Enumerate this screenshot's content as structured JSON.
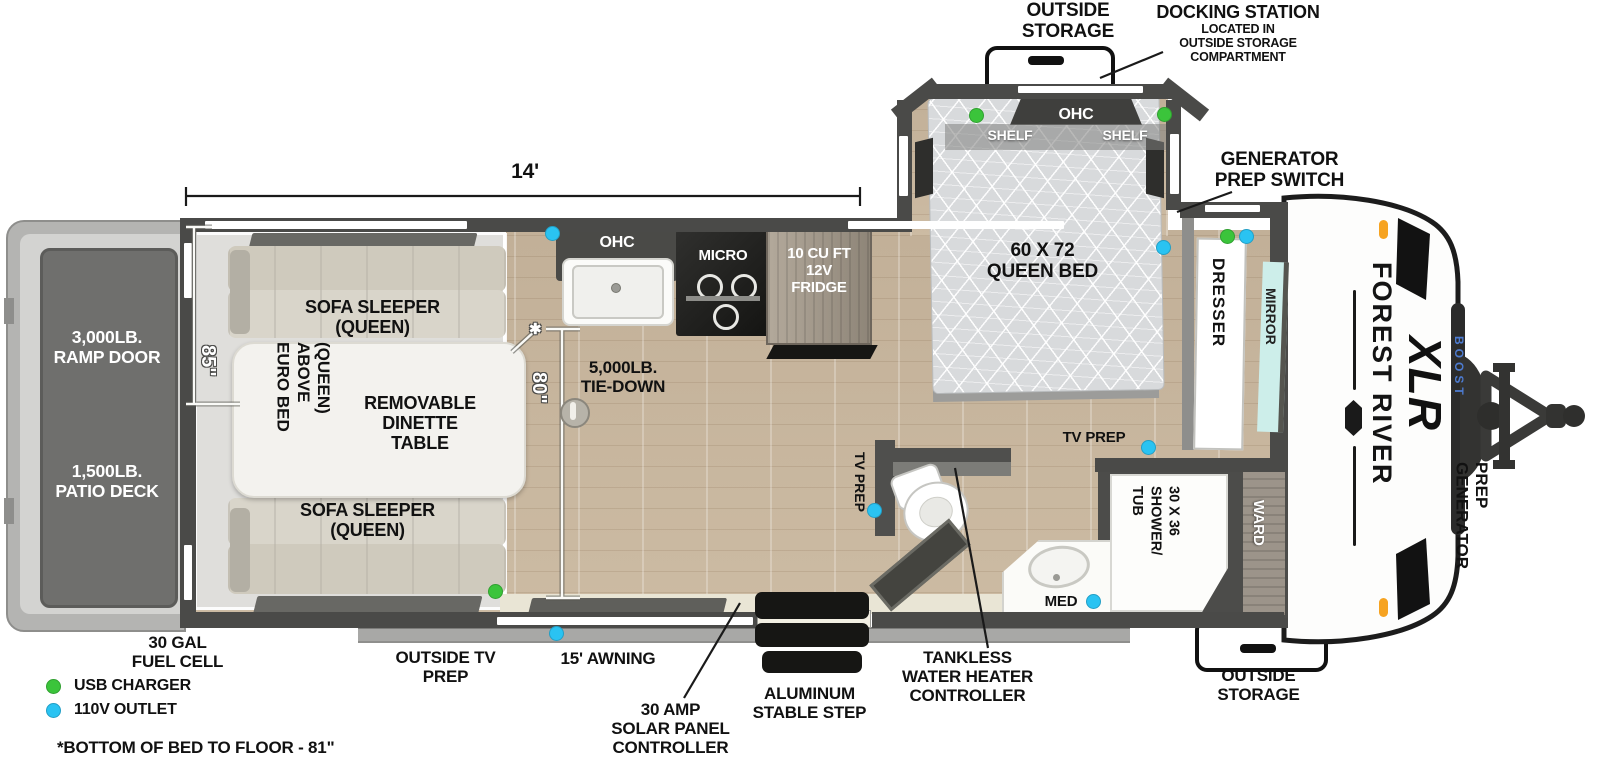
{
  "legend": {
    "usb_label": "USB CHARGER",
    "outlet_label": "110V OUTLET",
    "usb_color": "#3bc43b",
    "outlet_color": "#2ac3f2",
    "footnote": "*BOTTOM OF BED TO FLOOR - 81\""
  },
  "dimensions": {
    "length": "14'",
    "garage_depth": "85\"",
    "interior_height": "80\"",
    "floor_mark": "✱"
  },
  "exterior": {
    "outside_storage_top_l1": "OUTSIDE",
    "outside_storage_top_l2": "STORAGE",
    "docking_title": "DOCKING STATION",
    "docking_sub1": "LOCATED IN",
    "docking_sub2": "OUTSIDE STORAGE",
    "docking_sub3": "COMPARTMENT",
    "gen_switch_l1": "GENERATOR",
    "gen_switch_l2": "PREP SWITCH",
    "ramp_l1": "3,000LB.",
    "ramp_l2": "RAMP DOOR",
    "patio_l1": "1,500LB.",
    "patio_l2": "PATIO DECK",
    "fuel_l1": "30 GAL",
    "fuel_l2": "FUEL CELL",
    "outside_tv_l1": "OUTSIDE TV",
    "outside_tv_l2": "PREP",
    "awning": "15' AWNING",
    "solar_l1": "30 AMP",
    "solar_l2": "SOLAR PANEL",
    "solar_l3": "CONTROLLER",
    "step_l1": "ALUMINUM",
    "step_l2": "STABLE STEP",
    "outside_storage_bot_l1": "OUTSIDE",
    "outside_storage_bot_l2": "STORAGE",
    "gen_prep_l1": "GENERATOR",
    "gen_prep_l2": "PREP",
    "brand": "FOREST RIVER",
    "model": "XLR",
    "model_sub": "BOOST"
  },
  "garage": {
    "sofa_top_l1": "SOFA SLEEPER",
    "sofa_top_l2": "(QUEEN)",
    "sofa_bot_l1": "SOFA SLEEPER",
    "sofa_bot_l2": "(QUEEN)",
    "euro_l1": "EURO BED",
    "euro_l2": "ABOVE",
    "euro_l3": "(QUEEN)",
    "dinette_l1": "REMOVABLE",
    "dinette_l2": "DINETTE",
    "dinette_l3": "TABLE",
    "tiedown_l1": "5,000LB.",
    "tiedown_l2": "TIE-DOWN"
  },
  "kitchen": {
    "ohc": "OHC",
    "micro": "MICRO",
    "fridge_l1": "10 CU FT",
    "fridge_l2": "12V",
    "fridge_l3": "FRIDGE"
  },
  "bedroom": {
    "ohc": "OHC",
    "shelf_left": "SHELF",
    "shelf_right": "SHELF",
    "bed_l1": "60 X 72",
    "bed_l2": "QUEEN BED",
    "dresser": "DRESSER",
    "mirror": "MIRROR",
    "tv_prep": "TV PREP"
  },
  "bathroom": {
    "tv_prep": "TV PREP",
    "med": "MED",
    "shower_l1": "30 X 36",
    "shower_l2": "SHOWER/",
    "shower_l3": "TUB",
    "ward": "WARD",
    "tankless_l1": "TANKLESS",
    "tankless_l2": "WATER HEATER",
    "tankless_l3": "CONTROLLER"
  }
}
